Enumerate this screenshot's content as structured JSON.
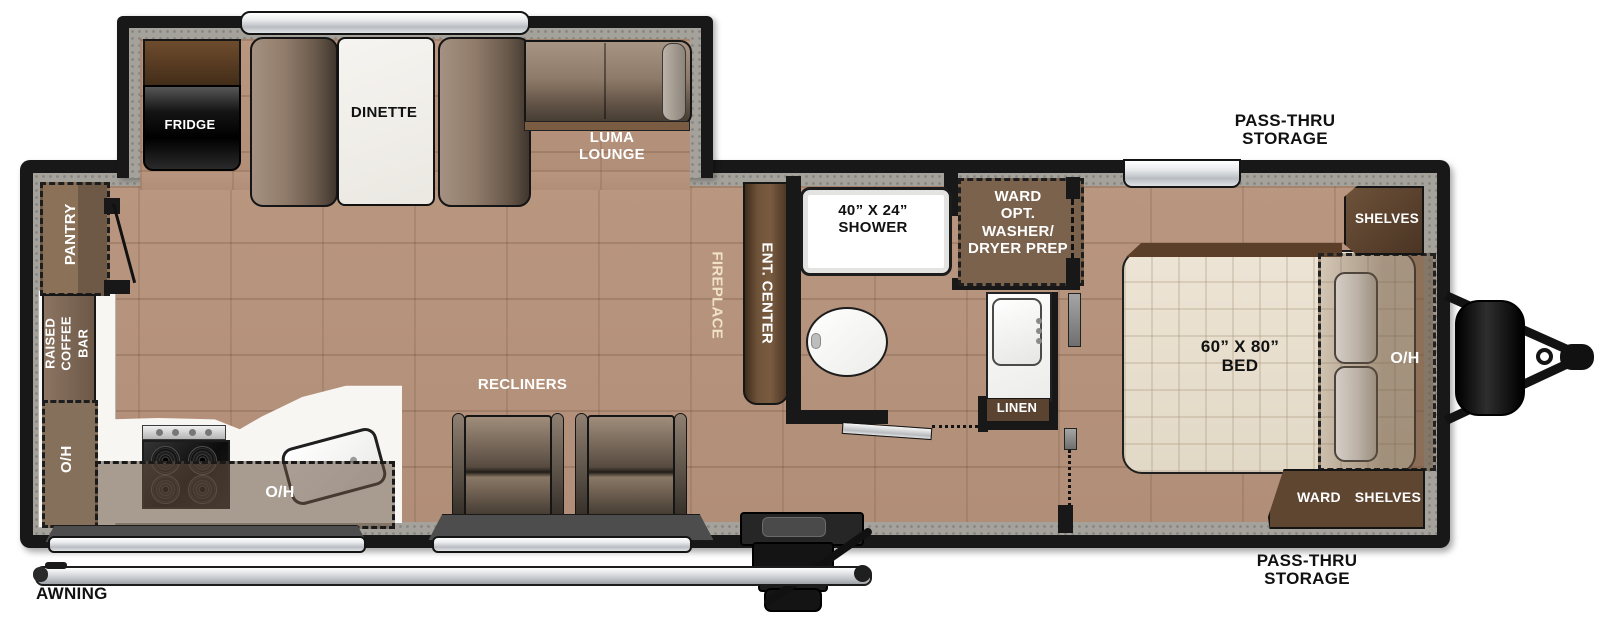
{
  "title": "Travel trailer floorplan",
  "floorplan": {
    "slideout": {
      "fridge": "FRIDGE",
      "dinette": "DINETTE",
      "lounge_line1": "LUMA",
      "lounge_line2": "LOUNGE"
    },
    "kitchen": {
      "pantry": "PANTRY",
      "coffee_bar_line1": "RAISED",
      "coffee_bar_line2": "COFFEE",
      "coffee_bar_line3": "BAR",
      "overhead_left": "O/H",
      "overhead_counter": "O/H"
    },
    "living": {
      "recliners": "RECLINERS",
      "fireplace": "FIREPLACE",
      "ent_center": "ENT. CENTER"
    },
    "bath": {
      "shower_line1": "40” X 24”",
      "shower_line2": "SHOWER",
      "ward_line1": "WARD",
      "ward_line2": "OPT.",
      "ward_line3": "WASHER/",
      "ward_line4": "DRYER PREP",
      "linen": "LINEN"
    },
    "bedroom": {
      "bed_line1": "60” X 80”",
      "bed_line2": "BED",
      "overhead_bed": "O/H",
      "shelves_top": "SHELVES",
      "ward": "WARD",
      "shelves_bottom": "SHELVES"
    },
    "exterior": {
      "pass_thru_top_line1": "PASS-THRU",
      "pass_thru_top_line2": "STORAGE",
      "pass_thru_bottom_line1": "PASS-THRU",
      "pass_thru_bottom_line2": "STORAGE",
      "awning": "AWNING"
    }
  },
  "colors": {
    "wall": "#181818",
    "wood_floor": "#b6937d",
    "carpet": "#a5a29c",
    "cabinet_brown": "#6f5339",
    "label_brown": "#5a4330",
    "counter_white": "#f7f6f3",
    "mattress": "#e9e0d1",
    "window_silver": "#d7dadd"
  }
}
